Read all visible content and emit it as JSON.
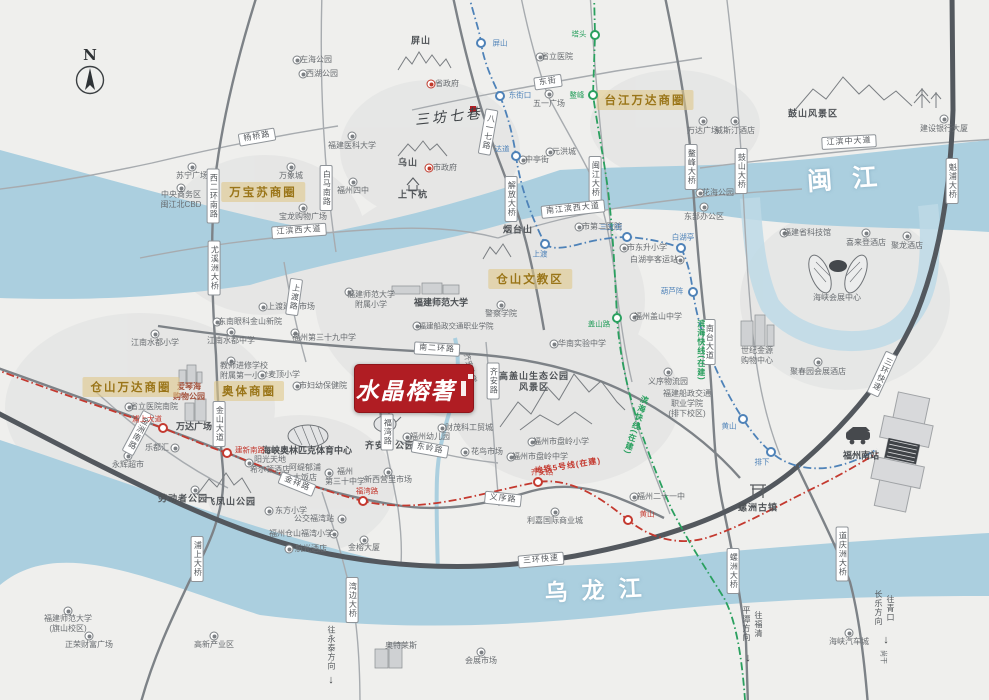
{
  "compass": {
    "letter": "N"
  },
  "logo": {
    "name": "水晶榕著"
  },
  "colors": {
    "logo_red": "#b01d23",
    "badge_bg": "#e0c88a",
    "badge_text": "#9a7518",
    "river": "#abcfdf",
    "ring_road": "#53585e",
    "road": "#9aa0a5",
    "metro_blue": "#4e82b8",
    "metro_green": "#2aa05f",
    "metro_red": "#c4392f"
  },
  "rivers": [
    {
      "name": "闽江",
      "x": 852,
      "y": 177,
      "rot": -4,
      "ls": 20,
      "fs": 25
    },
    {
      "name": "乌龙江",
      "x": 600,
      "y": 588,
      "rot": -3,
      "ls": 14,
      "fs": 23
    }
  ],
  "badges": [
    {
      "t": "万宝苏商圈",
      "x": 263,
      "y": 192
    },
    {
      "t": "台江万达商圈",
      "x": 645,
      "y": 100
    },
    {
      "t": "仓山文教区",
      "x": 530,
      "y": 279
    },
    {
      "t": "仓山万达商圈",
      "x": 131,
      "y": 387
    },
    {
      "t": "奥体商圈",
      "x": 249,
      "y": 391
    }
  ],
  "road_labels": [
    {
      "t": "杨桥路",
      "x": 257,
      "y": 137,
      "r": -10
    },
    {
      "t": "西二环南路",
      "x": 213,
      "y": 196,
      "v": 1
    },
    {
      "t": "白马南路",
      "x": 326,
      "y": 188,
      "v": 1
    },
    {
      "t": "东街",
      "x": 548,
      "y": 82,
      "r": -8
    },
    {
      "t": "八一七路",
      "x": 488,
      "y": 132,
      "v": 1,
      "r": 10
    },
    {
      "t": "解放大桥",
      "x": 511,
      "y": 199,
      "v": 1
    },
    {
      "t": "闽江大桥",
      "x": 595,
      "y": 179,
      "v": 1
    },
    {
      "t": "南江滨西大道",
      "x": 573,
      "y": 209,
      "r": -6
    },
    {
      "t": "江滨西大道",
      "x": 299,
      "y": 231,
      "r": -4
    },
    {
      "t": "江滨中大道",
      "x": 849,
      "y": 142,
      "r": -3
    },
    {
      "t": "鳌峰大桥",
      "x": 691,
      "y": 167,
      "v": 1
    },
    {
      "t": "鼓山大桥",
      "x": 741,
      "y": 171,
      "v": 1
    },
    {
      "t": "魁浦大桥",
      "x": 952,
      "y": 181,
      "v": 1
    },
    {
      "t": "三环快速",
      "x": 882,
      "y": 374,
      "v": 1,
      "r": 25
    },
    {
      "t": "三环快速",
      "x": 541,
      "y": 560,
      "r": -5
    },
    {
      "t": "南二环路",
      "x": 437,
      "y": 349,
      "r": 3
    },
    {
      "t": "上渡路",
      "x": 294,
      "y": 297,
      "v": 1,
      "r": 8
    },
    {
      "t": "尤溪洲大桥",
      "x": 214,
      "y": 268,
      "v": 1
    },
    {
      "t": "金山大道",
      "x": 219,
      "y": 424,
      "v": 1
    },
    {
      "t": "金洲南路",
      "x": 138,
      "y": 433,
      "v": 1,
      "r": 28
    },
    {
      "t": "浦上大桥",
      "x": 197,
      "y": 559,
      "v": 1
    },
    {
      "t": "湾边大桥",
      "x": 352,
      "y": 600,
      "v": 1
    },
    {
      "t": "螺洲大桥",
      "x": 733,
      "y": 571,
      "v": 1
    },
    {
      "t": "道庆洲大桥",
      "x": 842,
      "y": 554,
      "v": 1
    },
    {
      "t": "南台大道",
      "x": 709,
      "y": 342,
      "v": 1
    },
    {
      "t": "福湾路",
      "x": 387,
      "y": 432,
      "v": 1
    },
    {
      "t": "齐安路",
      "x": 493,
      "y": 381,
      "v": 1
    },
    {
      "t": "东岭路",
      "x": 430,
      "y": 449,
      "r": 10
    },
    {
      "t": "金祥路",
      "x": 297,
      "y": 484,
      "r": 22
    },
    {
      "t": "义序路",
      "x": 503,
      "y": 499,
      "r": 6
    }
  ],
  "metro": {
    "lines": [
      {
        "key": "blue",
        "color": "#4e82b8",
        "labels": [],
        "stations": [
          {
            "t": "屏山",
            "x": 481,
            "y": 43,
            "lx": 500,
            "ly": 43
          },
          {
            "t": "东街口",
            "x": 500,
            "y": 96,
            "lx": 520,
            "ly": 95
          },
          {
            "t": "达道",
            "x": 516,
            "y": 156,
            "lx": 502,
            "ly": 149
          },
          {
            "t": "上渡",
            "x": 545,
            "y": 244,
            "lx": 540,
            "ly": 254
          },
          {
            "t": "三叉街",
            "x": 627,
            "y": 237,
            "lx": 611,
            "ly": 227
          },
          {
            "t": "白湖亭",
            "x": 681,
            "y": 248,
            "lx": 683,
            "ly": 237
          },
          {
            "t": "葫芦阵",
            "x": 693,
            "y": 292,
            "lx": 672,
            "ly": 291
          },
          {
            "t": "黄山",
            "x": 743,
            "y": 419,
            "lx": 729,
            "ly": 426
          },
          {
            "t": "排下",
            "x": 771,
            "y": 452,
            "lx": 762,
            "ly": 462
          }
        ]
      },
      {
        "key": "green",
        "color": "#2aa05f",
        "labels": [
          {
            "t": "滨海快线(在建)",
            "x": 701,
            "y": 350,
            "v": 1
          },
          {
            "t": "滨海快线(在建)",
            "x": 636,
            "y": 425,
            "v": 1,
            "r": 18
          }
        ],
        "stations": [
          {
            "t": "塔头",
            "x": 595,
            "y": 35,
            "lx": 579,
            "ly": 34
          },
          {
            "t": "鳌峰",
            "x": 593,
            "y": 95,
            "lx": 577,
            "ly": 95
          },
          {
            "t": "盖山路",
            "x": 617,
            "y": 318,
            "lx": 599,
            "ly": 324
          }
        ]
      },
      {
        "key": "red",
        "color": "#c4392f",
        "labels": [
          {
            "t": "地铁5号线(在建)",
            "x": 568,
            "y": 466,
            "r": -9
          }
        ],
        "stations": [
          {
            "t": "浦上大道",
            "x": 163,
            "y": 428,
            "lx": 147,
            "ly": 419
          },
          {
            "t": "建新南路",
            "x": 227,
            "y": 453,
            "lx": 250,
            "ly": 450
          },
          {
            "t": "福湾路",
            "x": 363,
            "y": 501,
            "lx": 367,
            "ly": 491
          },
          {
            "t": "齐安路",
            "x": 538,
            "y": 482,
            "lx": 542,
            "ly": 472
          },
          {
            "t": "黄山",
            "x": 628,
            "y": 520,
            "lx": 647,
            "ly": 514
          }
        ]
      }
    ]
  },
  "directions": [
    {
      "t": "往永泰方向",
      "x": 331,
      "y": 648,
      "ax": 331,
      "ay": 680
    },
    {
      "t": "往福清\n平潭方向",
      "x": 752,
      "y": 624,
      "ax": 748,
      "ay": 658
    },
    {
      "t": "往青口\n长乐方向",
      "x": 884,
      "y": 608,
      "ax": 886,
      "ay": 640
    }
  ],
  "pois": [
    {
      "t": "左海公园",
      "x": 316,
      "y": 60,
      "i": [
        297,
        60
      ]
    },
    {
      "t": "西湖公园",
      "x": 322,
      "y": 74,
      "i": [
        303,
        74
      ]
    },
    {
      "t": "苏宁广场",
      "x": 192,
      "y": 176,
      "i": [
        192,
        167
      ]
    },
    {
      "t": "中央商务区\n闽江北CBD",
      "x": 181,
      "y": 200,
      "i": [
        181,
        188
      ]
    },
    {
      "t": "万象城",
      "x": 291,
      "y": 176,
      "i": [
        291,
        167
      ]
    },
    {
      "t": "宝龙购物广场",
      "x": 303,
      "y": 217,
      "i": [
        303,
        208
      ]
    },
    {
      "t": "屏山",
      "x": 421,
      "y": 41,
      "cls": "park"
    },
    {
      "t": "省政府",
      "x": 447,
      "y": 84,
      "i": [
        431,
        84
      ],
      "it": "r"
    },
    {
      "t": "三坊七巷",
      "x": 449,
      "y": 118,
      "cls": "calli",
      "rot": -6
    },
    {
      "t": "福建医科大学",
      "x": 352,
      "y": 146,
      "i": [
        352,
        136
      ]
    },
    {
      "t": "福州四中",
      "x": 353,
      "y": 191,
      "i": [
        353,
        182
      ]
    },
    {
      "t": "乌山",
      "x": 408,
      "y": 163,
      "cls": "park"
    },
    {
      "t": "市政府",
      "x": 445,
      "y": 168,
      "i": [
        429,
        168
      ],
      "it": "r"
    },
    {
      "t": "上下杭",
      "x": 413,
      "y": 195,
      "cls": "park"
    },
    {
      "t": "省立医院",
      "x": 557,
      "y": 57,
      "i": [
        540,
        57
      ]
    },
    {
      "t": "五一广场",
      "x": 549,
      "y": 104,
      "i": [
        549,
        94
      ]
    },
    {
      "t": "中亭街",
      "x": 537,
      "y": 160,
      "i": [
        523,
        160
      ]
    },
    {
      "t": "元洪城",
      "x": 564,
      "y": 152,
      "i": [
        550,
        152
      ]
    },
    {
      "t": "万达广场",
      "x": 703,
      "y": 131,
      "i": [
        703,
        121
      ]
    },
    {
      "t": "威斯汀酒店",
      "x": 735,
      "y": 131,
      "i": [
        735,
        121
      ]
    },
    {
      "t": "建设银行大厦",
      "x": 944,
      "y": 129,
      "i": [
        944,
        119
      ]
    },
    {
      "t": "鼓山风景区",
      "x": 813,
      "y": 114,
      "cls": "park"
    },
    {
      "t": "花海公园",
      "x": 718,
      "y": 193,
      "i": [
        700,
        193
      ]
    },
    {
      "t": "东部办公区",
      "x": 704,
      "y": 217,
      "i": [
        704,
        207
      ]
    },
    {
      "t": "福建省科技馆",
      "x": 807,
      "y": 233,
      "i": [
        784,
        233
      ]
    },
    {
      "t": "喜来登酒店",
      "x": 866,
      "y": 243,
      "i": [
        866,
        233
      ]
    },
    {
      "t": "聚龙酒店",
      "x": 907,
      "y": 246,
      "i": [
        907,
        236
      ]
    },
    {
      "t": "海峡会展中心",
      "x": 837,
      "y": 298
    },
    {
      "t": "世纪金源\n购物中心",
      "x": 757,
      "y": 356
    },
    {
      "t": "聚春园会展酒店",
      "x": 818,
      "y": 372,
      "i": [
        818,
        362
      ]
    },
    {
      "t": "义序物流园",
      "x": 668,
      "y": 382,
      "i": [
        668,
        372
      ]
    },
    {
      "t": "福建船政交通\n职业学院\n(排下校区)",
      "x": 687,
      "y": 404
    },
    {
      "t": "市第二医院",
      "x": 602,
      "y": 227,
      "i": [
        579,
        227
      ]
    },
    {
      "t": "烟台山",
      "x": 518,
      "y": 230,
      "cls": "park"
    },
    {
      "t": "市东升小学",
      "x": 647,
      "y": 248,
      "i": [
        624,
        248
      ]
    },
    {
      "t": "白湖亭客运站",
      "x": 654,
      "y": 260,
      "i": [
        680,
        260
      ]
    },
    {
      "t": "福州盖山中学",
      "x": 658,
      "y": 317,
      "i": [
        634,
        317
      ]
    },
    {
      "t": "警察学院",
      "x": 501,
      "y": 314,
      "i": [
        501,
        305
      ]
    },
    {
      "t": "福建师范大学\n附属小学",
      "x": 371,
      "y": 300,
      "i": [
        349,
        292
      ]
    },
    {
      "t": "福建师范大学",
      "x": 441,
      "y": 303,
      "cls": "big"
    },
    {
      "t": "福建船政交通职业学院",
      "x": 456,
      "y": 326,
      "i": [
        417,
        326
      ],
      "fs": 7.5
    },
    {
      "t": "福州第三十九中学",
      "x": 324,
      "y": 338,
      "i": [
        295,
        333
      ]
    },
    {
      "t": "上渡建材市场",
      "x": 291,
      "y": 307,
      "i": [
        263,
        307
      ]
    },
    {
      "t": "东南眼科金山新院",
      "x": 250,
      "y": 322,
      "i": [
        217,
        322
      ]
    },
    {
      "t": "江南水都小学",
      "x": 155,
      "y": 343,
      "i": [
        155,
        334
      ]
    },
    {
      "t": "江南水都中学",
      "x": 231,
      "y": 341,
      "i": [
        231,
        332
      ]
    },
    {
      "t": "教师进修学校\n附属第一小学",
      "x": 244,
      "y": 371,
      "i": [
        231,
        361
      ]
    },
    {
      "t": "麦顶小学",
      "x": 284,
      "y": 375,
      "i": [
        262,
        375
      ]
    },
    {
      "t": "爱琴海\n购物公园",
      "x": 189,
      "y": 392,
      "cls": "aqua"
    },
    {
      "t": "省立医院南院",
      "x": 154,
      "y": 407,
      "i": [
        129,
        407
      ]
    },
    {
      "t": "万达广场",
      "x": 194,
      "y": 427,
      "cls": "big"
    },
    {
      "t": "乐都汇",
      "x": 157,
      "y": 448,
      "i": [
        175,
        448
      ]
    },
    {
      "t": "永辉超市",
      "x": 128,
      "y": 465,
      "i": [
        128,
        456
      ]
    },
    {
      "t": "市妇幼保健院",
      "x": 323,
      "y": 386,
      "i": [
        297,
        386
      ]
    },
    {
      "t": "海峡奥林匹克体育中心",
      "x": 307,
      "y": 451,
      "cls": "big"
    },
    {
      "t": "阳光天地\n希尔顿酒店",
      "x": 270,
      "y": 465,
      "i": [
        249,
        463
      ]
    },
    {
      "t": "阿缇郁浦\n大饭店",
      "x": 305,
      "y": 473
    },
    {
      "t": "福州\n第三十中学",
      "x": 345,
      "y": 477,
      "i": [
        329,
        473
      ]
    },
    {
      "t": "劳动者公园",
      "x": 183,
      "y": 499,
      "i": [
        195,
        490
      ],
      "cls": "park"
    },
    {
      "t": "飞凤山公园",
      "x": 231,
      "y": 502,
      "cls": "park"
    },
    {
      "t": "东方小学",
      "x": 291,
      "y": 511,
      "i": [
        269,
        511
      ]
    },
    {
      "t": "公交福湾站",
      "x": 314,
      "y": 519,
      "i": [
        342,
        519
      ]
    },
    {
      "t": "福州仓山福湾小学",
      "x": 301,
      "y": 534,
      "i": [
        334,
        534
      ]
    },
    {
      "t": "航光酒店",
      "x": 311,
      "y": 549,
      "i": [
        289,
        549
      ]
    },
    {
      "t": "金榕大厦",
      "x": 364,
      "y": 548,
      "i": [
        364,
        540
      ]
    },
    {
      "t": "新西营里市场",
      "x": 388,
      "y": 480,
      "i": [
        388,
        472
      ]
    },
    {
      "t": "福州幼儿园",
      "x": 430,
      "y": 437,
      "i": [
        407,
        437
      ]
    },
    {
      "t": "财茂科工贸城",
      "x": 469,
      "y": 428,
      "i": [
        442,
        428
      ]
    },
    {
      "t": "花鸟市场",
      "x": 487,
      "y": 452,
      "i": [
        465,
        452
      ]
    },
    {
      "t": "齐安山公园",
      "x": 390,
      "y": 446,
      "cls": "park"
    },
    {
      "t": "齐安小学",
      "x": 470,
      "y": 368,
      "rot": 75,
      "fs": 7.5
    },
    {
      "t": "高盖山生态公园\n风景区",
      "x": 534,
      "y": 382,
      "cls": "park"
    },
    {
      "t": "华南实验中学",
      "x": 582,
      "y": 344,
      "i": [
        554,
        344
      ]
    },
    {
      "t": "福州市盘岭小学",
      "x": 561,
      "y": 442,
      "i": [
        532,
        442
      ]
    },
    {
      "t": "福州市盘岭中学",
      "x": 540,
      "y": 457,
      "i": [
        511,
        457
      ]
    },
    {
      "t": "利嘉国际商业城",
      "x": 555,
      "y": 521,
      "i": [
        555,
        512
      ]
    },
    {
      "t": "福州二十一中",
      "x": 661,
      "y": 497,
      "i": [
        634,
        497
      ]
    },
    {
      "t": "福建师范大学\n(旗山校区)",
      "x": 68,
      "y": 624,
      "i": [
        68,
        611
      ]
    },
    {
      "t": "正荣财富广场",
      "x": 89,
      "y": 645,
      "i": [
        89,
        636
      ]
    },
    {
      "t": "高新产业区",
      "x": 214,
      "y": 645,
      "i": [
        214,
        636
      ]
    },
    {
      "t": "奥特莱斯",
      "x": 401,
      "y": 646
    },
    {
      "t": "会展市场",
      "x": 481,
      "y": 661,
      "i": [
        481,
        652
      ]
    },
    {
      "t": "海峡汽车城",
      "x": 849,
      "y": 642,
      "i": [
        849,
        633
      ]
    },
    {
      "t": "福州南站",
      "x": 861,
      "y": 456,
      "cls": "big"
    },
    {
      "t": "螺洲古镇",
      "x": 758,
      "y": 508,
      "cls": "park"
    },
    {
      "t": "尚干",
      "x": 882,
      "y": 657,
      "rot": 90,
      "fs": 7
    }
  ]
}
